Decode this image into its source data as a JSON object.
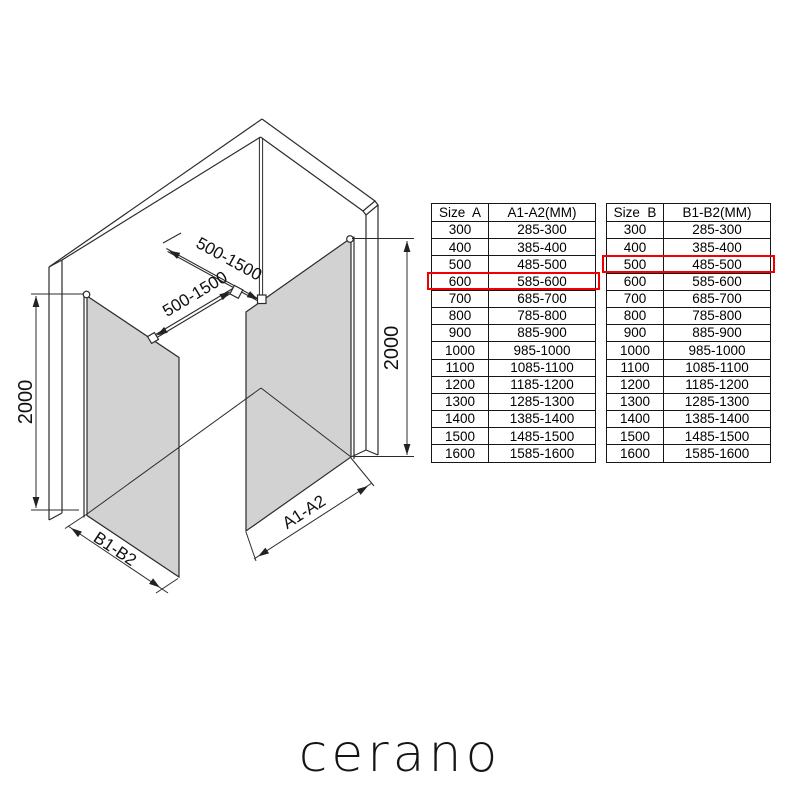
{
  "diagram": {
    "labels": {
      "bar_top_dim": "500-1500",
      "bar_bottom_dim": "500-1500",
      "height_left_dim": "2000",
      "height_right_dim": "2000",
      "panel_b_width_dim": "B1-B2",
      "panel_a_width_dim": "A1-A2"
    },
    "glass_color": "#d2d2d2",
    "line_color": "#2b2b2b"
  },
  "tables": {
    "highlight_color": "#f20000",
    "table_a": {
      "headers": [
        "Size  A",
        "A1-A2(MM)"
      ],
      "rows": [
        [
          "300",
          "285-300"
        ],
        [
          "400",
          "385-400"
        ],
        [
          "500",
          "485-500"
        ],
        [
          "600",
          "585-600"
        ],
        [
          "700",
          "685-700"
        ],
        [
          "800",
          "785-800"
        ],
        [
          "900",
          "885-900"
        ],
        [
          "1000",
          "985-1000"
        ],
        [
          "1100",
          "1085-1100"
        ],
        [
          "1200",
          "1185-1200"
        ],
        [
          "1300",
          "1285-1300"
        ],
        [
          "1400",
          "1385-1400"
        ],
        [
          "1500",
          "1485-1500"
        ],
        [
          "1600",
          "1585-1600"
        ]
      ],
      "highlighted_row_index": 3,
      "highlighted_row": [
        "600",
        "585-600"
      ]
    },
    "table_b": {
      "headers": [
        "Size  B",
        "B1-B2(MM)"
      ],
      "rows": [
        [
          "300",
          "285-300"
        ],
        [
          "400",
          "385-400"
        ],
        [
          "500",
          "485-500"
        ],
        [
          "600",
          "585-600"
        ],
        [
          "700",
          "685-700"
        ],
        [
          "800",
          "785-800"
        ],
        [
          "900",
          "885-900"
        ],
        [
          "1000",
          "985-1000"
        ],
        [
          "1100",
          "1085-1100"
        ],
        [
          "1200",
          "1185-1200"
        ],
        [
          "1300",
          "1285-1300"
        ],
        [
          "1400",
          "1385-1400"
        ],
        [
          "1500",
          "1485-1500"
        ],
        [
          "1600",
          "1585-1600"
        ]
      ],
      "highlighted_row_index": 2,
      "highlighted_row": [
        "500",
        "485-500"
      ]
    }
  },
  "logo": {
    "text": "cerano"
  }
}
